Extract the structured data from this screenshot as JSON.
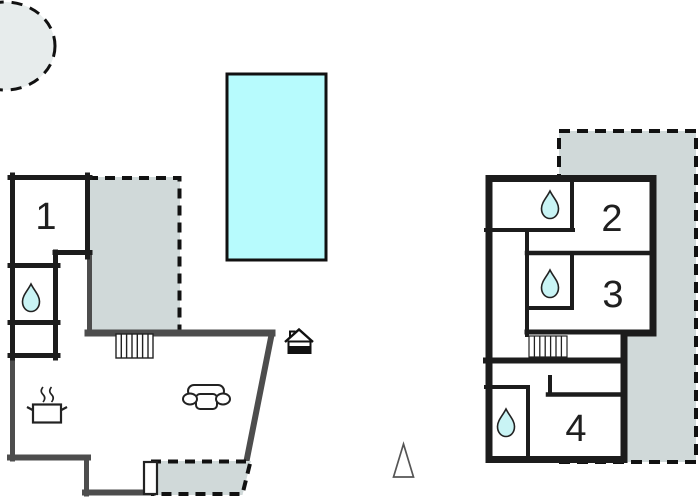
{
  "floorplan": {
    "title": "holiday-home floor plan",
    "rooms": {
      "r1": {
        "label": "1"
      },
      "r2": {
        "label": "2"
      },
      "r3": {
        "label": "3"
      },
      "r4": {
        "label": "4"
      }
    },
    "features": {
      "pool": "swimming-pool",
      "terraces": 3,
      "round_patio": 1,
      "bathroom_drops": 4,
      "stairs": 2,
      "sofa": 1,
      "cooking_pot": 1,
      "entrance_house_icon": 1,
      "north_triangle": 1,
      "entrance_door": 1
    },
    "colors": {
      "pool": "#b7fbfd",
      "terrace": "#d0d9d9",
      "drop": "#c9f4f5",
      "circle": "#e7ecec",
      "wall_dark": "#1c1c1c",
      "wall_gray": "#4d4d4d",
      "white": "#ffffff"
    }
  }
}
